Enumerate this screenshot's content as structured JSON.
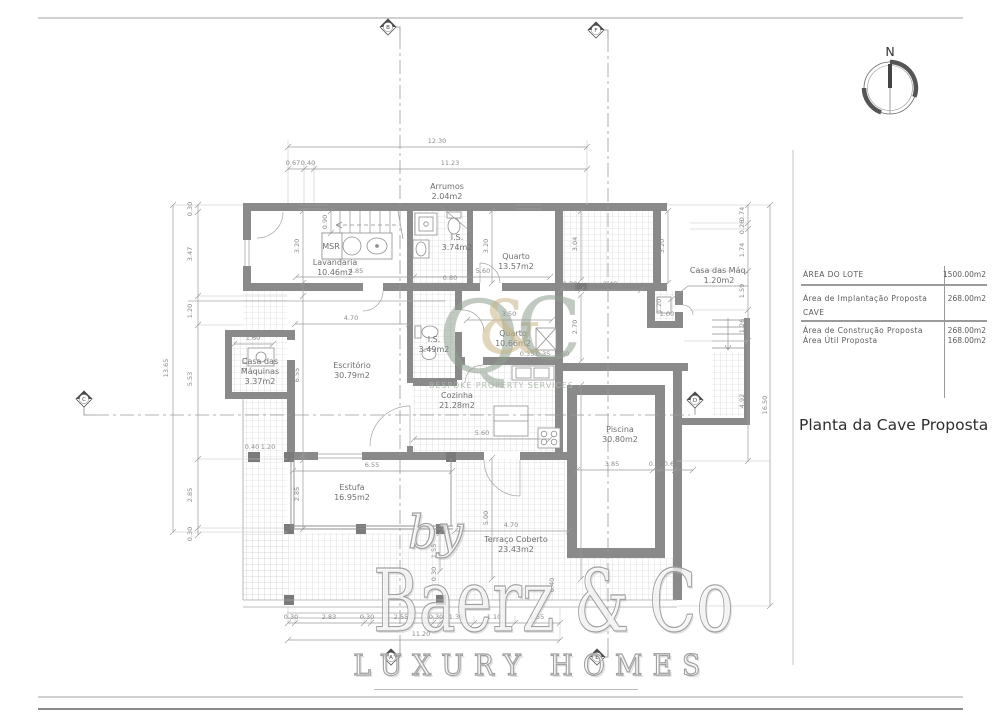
{
  "colors": {
    "wall": "#8a8a8a",
    "hatch": "#cccccc",
    "dim_text": "#8c8c8c",
    "logo_green": "#8e9f8e",
    "logo_gold": "#c9b584"
  },
  "sheet": {
    "compass_n": "N"
  },
  "title_block": {
    "rows": [
      {
        "label": "ÁREA DO LOTE",
        "value": "1500.00m2"
      },
      {
        "label": "Área de Implantação Proposta",
        "sublabel": "CAVE",
        "value": "268.00m2"
      },
      {
        "label": "Área de Construção Proposta",
        "sublabel": "Área Útil Proposta",
        "value": "268.00m2",
        "subvalue": "168.00m2"
      }
    ],
    "title": "Planta da Cave Proposta"
  },
  "watermark": {
    "by": "by",
    "brand": "Baerz & Co",
    "tagline": "LUXURY HOMES"
  },
  "logo": {
    "q": "Q",
    "amp": "&",
    "c": "C",
    "tagline": "BESPOKE PROPERTY SERVICES"
  },
  "plan": {
    "rooms": [
      {
        "lines": [
          "Arrumos",
          "2.04m2"
        ],
        "x": 447,
        "y": 189
      },
      {
        "lines": [
          "Lavandaria",
          "10.46m2"
        ],
        "x": 335,
        "y": 265
      },
      {
        "lines": [
          "I.S.",
          "3.74m2"
        ],
        "x": 457,
        "y": 240
      },
      {
        "lines": [
          "Quarto",
          "13.57m2"
        ],
        "x": 516,
        "y": 259
      },
      {
        "lines": [
          "Casa das Máq.",
          "1.20m2"
        ],
        "x": 719,
        "y": 273
      },
      {
        "lines": [
          "Quarto",
          "10.66m2"
        ],
        "x": 513,
        "y": 336
      },
      {
        "lines": [
          "I.S.",
          "3.49m2"
        ],
        "x": 434,
        "y": 342
      },
      {
        "lines": [
          "Escritório",
          "30.79m2"
        ],
        "x": 352,
        "y": 368
      },
      {
        "lines": [
          "Casa das",
          "Máquinas",
          "3.37m2"
        ],
        "x": 260,
        "y": 364,
        "fs": 6.5
      },
      {
        "lines": [
          "Cozinha",
          "21.28m2"
        ],
        "x": 457,
        "y": 398
      },
      {
        "lines": [
          "Piscina",
          "30.80m2"
        ],
        "x": 620,
        "y": 432
      },
      {
        "lines": [
          "Estufa",
          "16.95m2"
        ],
        "x": 352,
        "y": 490
      },
      {
        "lines": [
          "Terraço Coberto",
          "23.43m2"
        ],
        "x": 516,
        "y": 542
      },
      {
        "lines": [
          "MSR"
        ],
        "x": 331,
        "y": 249,
        "fs": 5.5
      }
    ],
    "dims": [
      {
        "t": "12.30",
        "x": 437,
        "y": 143
      },
      {
        "t": "0.67",
        "x": 293,
        "y": 165,
        "fs": 5.5
      },
      {
        "t": "0.40",
        "x": 308,
        "y": 165,
        "fs": 5.5
      },
      {
        "t": "11.23",
        "x": 450,
        "y": 165
      },
      {
        "t": "13.65",
        "x": 168,
        "y": 368,
        "r": 1
      },
      {
        "t": "0.30",
        "x": 192,
        "y": 209,
        "r": 1,
        "fs": 5
      },
      {
        "t": "3.47",
        "x": 192,
        "y": 254,
        "r": 1
      },
      {
        "t": "1.20",
        "x": 192,
        "y": 311,
        "r": 1
      },
      {
        "t": "5.53",
        "x": 192,
        "y": 379,
        "r": 1
      },
      {
        "t": "2.85",
        "x": 192,
        "y": 495,
        "r": 1
      },
      {
        "t": "0.30",
        "x": 192,
        "y": 534,
        "r": 1,
        "fs": 5
      },
      {
        "t": "0.74",
        "x": 744,
        "y": 214,
        "r": 1,
        "fs": 5
      },
      {
        "t": "0.26",
        "x": 744,
        "y": 227,
        "r": 1,
        "fs": 5
      },
      {
        "t": "1.74",
        "x": 744,
        "y": 250,
        "r": 1
      },
      {
        "t": "1.59",
        "x": 744,
        "y": 291,
        "r": 1
      },
      {
        "t": "1.26",
        "x": 744,
        "y": 326,
        "r": 1
      },
      {
        "t": "4.92",
        "x": 744,
        "y": 401,
        "r": 1
      },
      {
        "t": "16.50",
        "x": 767,
        "y": 405,
        "r": 1
      },
      {
        "t": "0.30",
        "x": 291,
        "y": 619,
        "fs": 5.5
      },
      {
        "t": "2.83",
        "x": 329,
        "y": 619
      },
      {
        "t": "0.30",
        "x": 367,
        "y": 619,
        "fs": 5.5
      },
      {
        "t": "2.55",
        "x": 401,
        "y": 619,
        "fs": 5.5
      },
      {
        "t": "0.30",
        "x": 436,
        "y": 619,
        "fs": 5.5
      },
      {
        "t": "1.38",
        "x": 456,
        "y": 619,
        "fs": 5.5
      },
      {
        "t": "1.10",
        "x": 494,
        "y": 619,
        "fs": 5.5
      },
      {
        "t": "1.55",
        "x": 537,
        "y": 619,
        "fs": 5.5
      },
      {
        "t": "11.20",
        "x": 421,
        "y": 636
      },
      {
        "t": "4.85",
        "x": 356,
        "y": 273
      },
      {
        "t": "5.60",
        "x": 483,
        "y": 273
      },
      {
        "t": "4.70",
        "x": 351,
        "y": 320
      },
      {
        "t": "3.50",
        "x": 509,
        "y": 316
      },
      {
        "t": "5.60",
        "x": 482,
        "y": 435
      },
      {
        "t": "6.55",
        "x": 372,
        "y": 467
      },
      {
        "t": "4.70",
        "x": 511,
        "y": 527
      },
      {
        "t": "0.80",
        "x": 570,
        "y": 286,
        "fs": 5.5
      },
      {
        "t": "2.48",
        "x": 610,
        "y": 286
      },
      {
        "t": "3.85",
        "x": 612,
        "y": 466
      },
      {
        "t": "0.30",
        "x": 656,
        "y": 466,
        "fs": 5
      },
      {
        "t": "0.60",
        "x": 671,
        "y": 466,
        "fs": 5
      },
      {
        "t": "1.60",
        "x": 253,
        "y": 340,
        "fs": 5.5
      },
      {
        "t": "1.00",
        "x": 667,
        "y": 316,
        "fs": 5
      },
      {
        "t": "0.40",
        "x": 252,
        "y": 449,
        "fs": 5
      },
      {
        "t": "1.20",
        "x": 268,
        "y": 449,
        "fs": 5
      },
      {
        "t": "0.80",
        "x": 450,
        "y": 280,
        "fs": 5
      },
      {
        "t": "0.35",
        "x": 527,
        "y": 356,
        "fs": 5
      },
      {
        "t": "0.35",
        "x": 543,
        "y": 356,
        "fs": 5
      },
      {
        "t": "0.60",
        "x": 562,
        "y": 356,
        "fs": 5
      },
      {
        "t": "3.20",
        "x": 299,
        "y": 246,
        "r": 1
      },
      {
        "t": "0.90",
        "x": 327,
        "y": 222,
        "r": 1,
        "fs": 5
      },
      {
        "t": "3.20",
        "x": 488,
        "y": 246,
        "r": 1
      },
      {
        "t": "3.20",
        "x": 664,
        "y": 246,
        "r": 1
      },
      {
        "t": "3.04",
        "x": 577,
        "y": 244,
        "r": 1
      },
      {
        "t": "2.70",
        "x": 577,
        "y": 327,
        "r": 1
      },
      {
        "t": "6.55",
        "x": 299,
        "y": 375,
        "r": 1
      },
      {
        "t": "2.85",
        "x": 299,
        "y": 494,
        "r": 1
      },
      {
        "t": "8.00",
        "x": 577,
        "y": 480,
        "r": 1
      },
      {
        "t": "5.00",
        "x": 488,
        "y": 518,
        "r": 1
      },
      {
        "t": "1.55",
        "x": 436,
        "y": 551,
        "r": 1,
        "fs": 5
      },
      {
        "t": "0.30",
        "x": 436,
        "y": 574,
        "r": 1,
        "fs": 5
      },
      {
        "t": "0.40",
        "x": 554,
        "y": 585,
        "r": 1,
        "fs": 5
      },
      {
        "t": "2.11",
        "x": 247,
        "y": 364,
        "r": 1,
        "fs": 5
      },
      {
        "t": "1.20",
        "x": 661,
        "y": 306,
        "r": 1,
        "fs": 5
      }
    ],
    "markers": [
      {
        "l": "A",
        "x": 391,
        "y": 657
      },
      {
        "l": "B",
        "x": 388,
        "y": 27
      },
      {
        "l": "C",
        "x": 84,
        "y": 399
      },
      {
        "l": "D",
        "x": 695,
        "y": 400
      },
      {
        "l": "E",
        "x": 597,
        "y": 657
      },
      {
        "l": "F",
        "x": 596,
        "y": 30
      }
    ]
  }
}
